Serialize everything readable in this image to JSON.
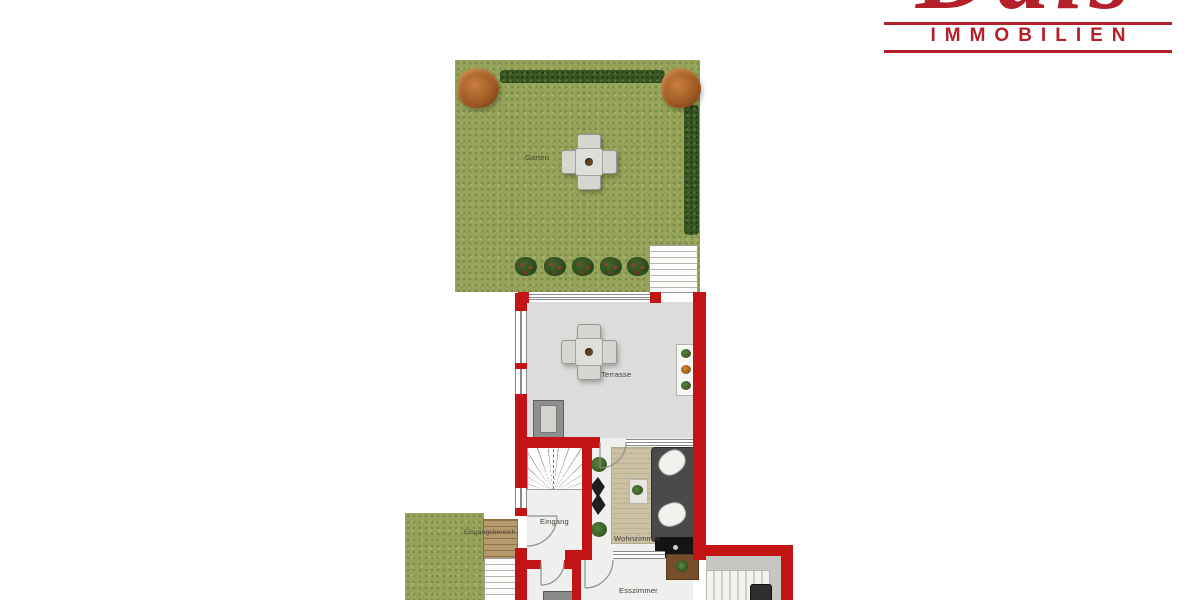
{
  "brand": {
    "name": "Dais",
    "subtitle": "IMMOBILIEN",
    "accent_color": "#b3202a"
  },
  "floorplan": {
    "wall_color": "#c21414",
    "grass_color": "#96a35a",
    "hedge_color": "#3a5822",
    "terrace_floor_color": "#dcdcda",
    "rooms": {
      "garden": "Garten",
      "terrace": "Terrasse",
      "entrance": "Eingang",
      "entrance_area": "Eingangsbereich",
      "living_room": "Wohnzimmer",
      "dining_room": "Esszimmer"
    },
    "icons": [
      "garden-table-icon",
      "terrace-table-icon",
      "tree-icon",
      "hedge-icon",
      "bush-icon",
      "plant-icon",
      "plant-shelf-icon",
      "stairs-icon",
      "winder-stairs-icon",
      "sofa-icon",
      "rug-icon",
      "tv-board-icon",
      "coffee-table-icon",
      "cabinet-icon",
      "lounge-chair-icon",
      "door-swing-icon"
    ]
  }
}
